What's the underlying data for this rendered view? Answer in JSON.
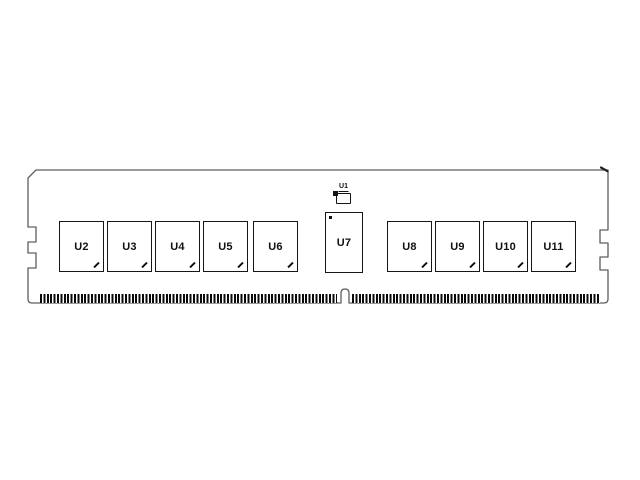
{
  "module": {
    "description": "memory module (DIMM) front view line diagram",
    "colors": {
      "background": "#ffffff",
      "pcb_outline": "#5f5f5f",
      "component_ink": "#161616",
      "pin_fingers": "#0a0a0a"
    },
    "spd": {
      "label": "U1"
    },
    "register": {
      "label": "U7"
    },
    "dram_left": [
      {
        "label": "U2"
      },
      {
        "label": "U3"
      },
      {
        "label": "U4"
      },
      {
        "label": "U5"
      },
      {
        "label": "U6"
      }
    ],
    "dram_right": [
      {
        "label": "U8"
      },
      {
        "label": "U9"
      },
      {
        "label": "U10"
      },
      {
        "label": "U11"
      }
    ]
  }
}
